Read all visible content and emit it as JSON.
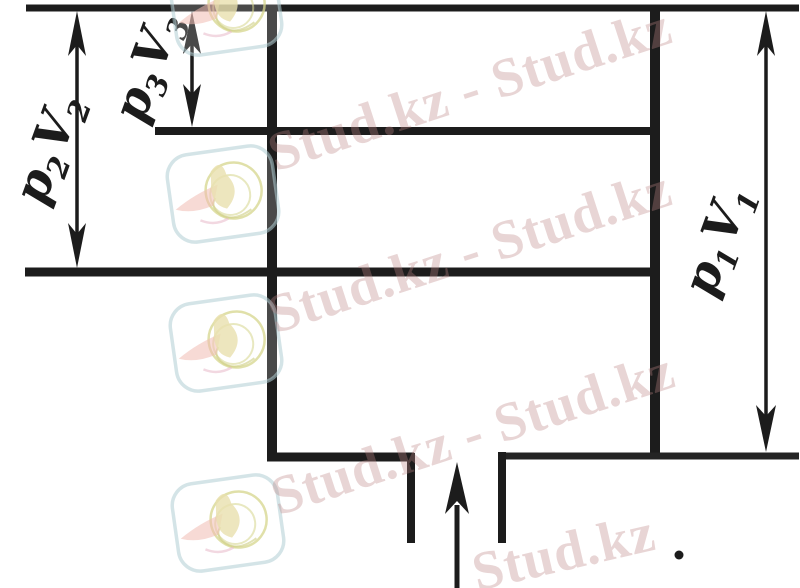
{
  "diagram": {
    "description": "scanned cylinder diagram with three gas states",
    "ink_color": "#1c1c1c",
    "labels": {
      "state1": {
        "p": "p",
        "p_sub": "1",
        "v": "V",
        "v_sub": "1"
      },
      "state2": {
        "p": "p",
        "p_sub": "2",
        "v": "V",
        "v_sub": "2"
      },
      "state3": {
        "p": "p",
        "p_sub": "3",
        "v": "V",
        "v_sub": "3"
      }
    }
  },
  "watermark": {
    "text": "Stud.kz - Stud.kz",
    "short_text": "Stud.kz",
    "text_color": "#bb8484",
    "logo_colors": {
      "frame": "#bcd2d8",
      "swirl": "#dcdc96",
      "body": "#e9e0ae",
      "wing": "#f0bcc0"
    }
  }
}
